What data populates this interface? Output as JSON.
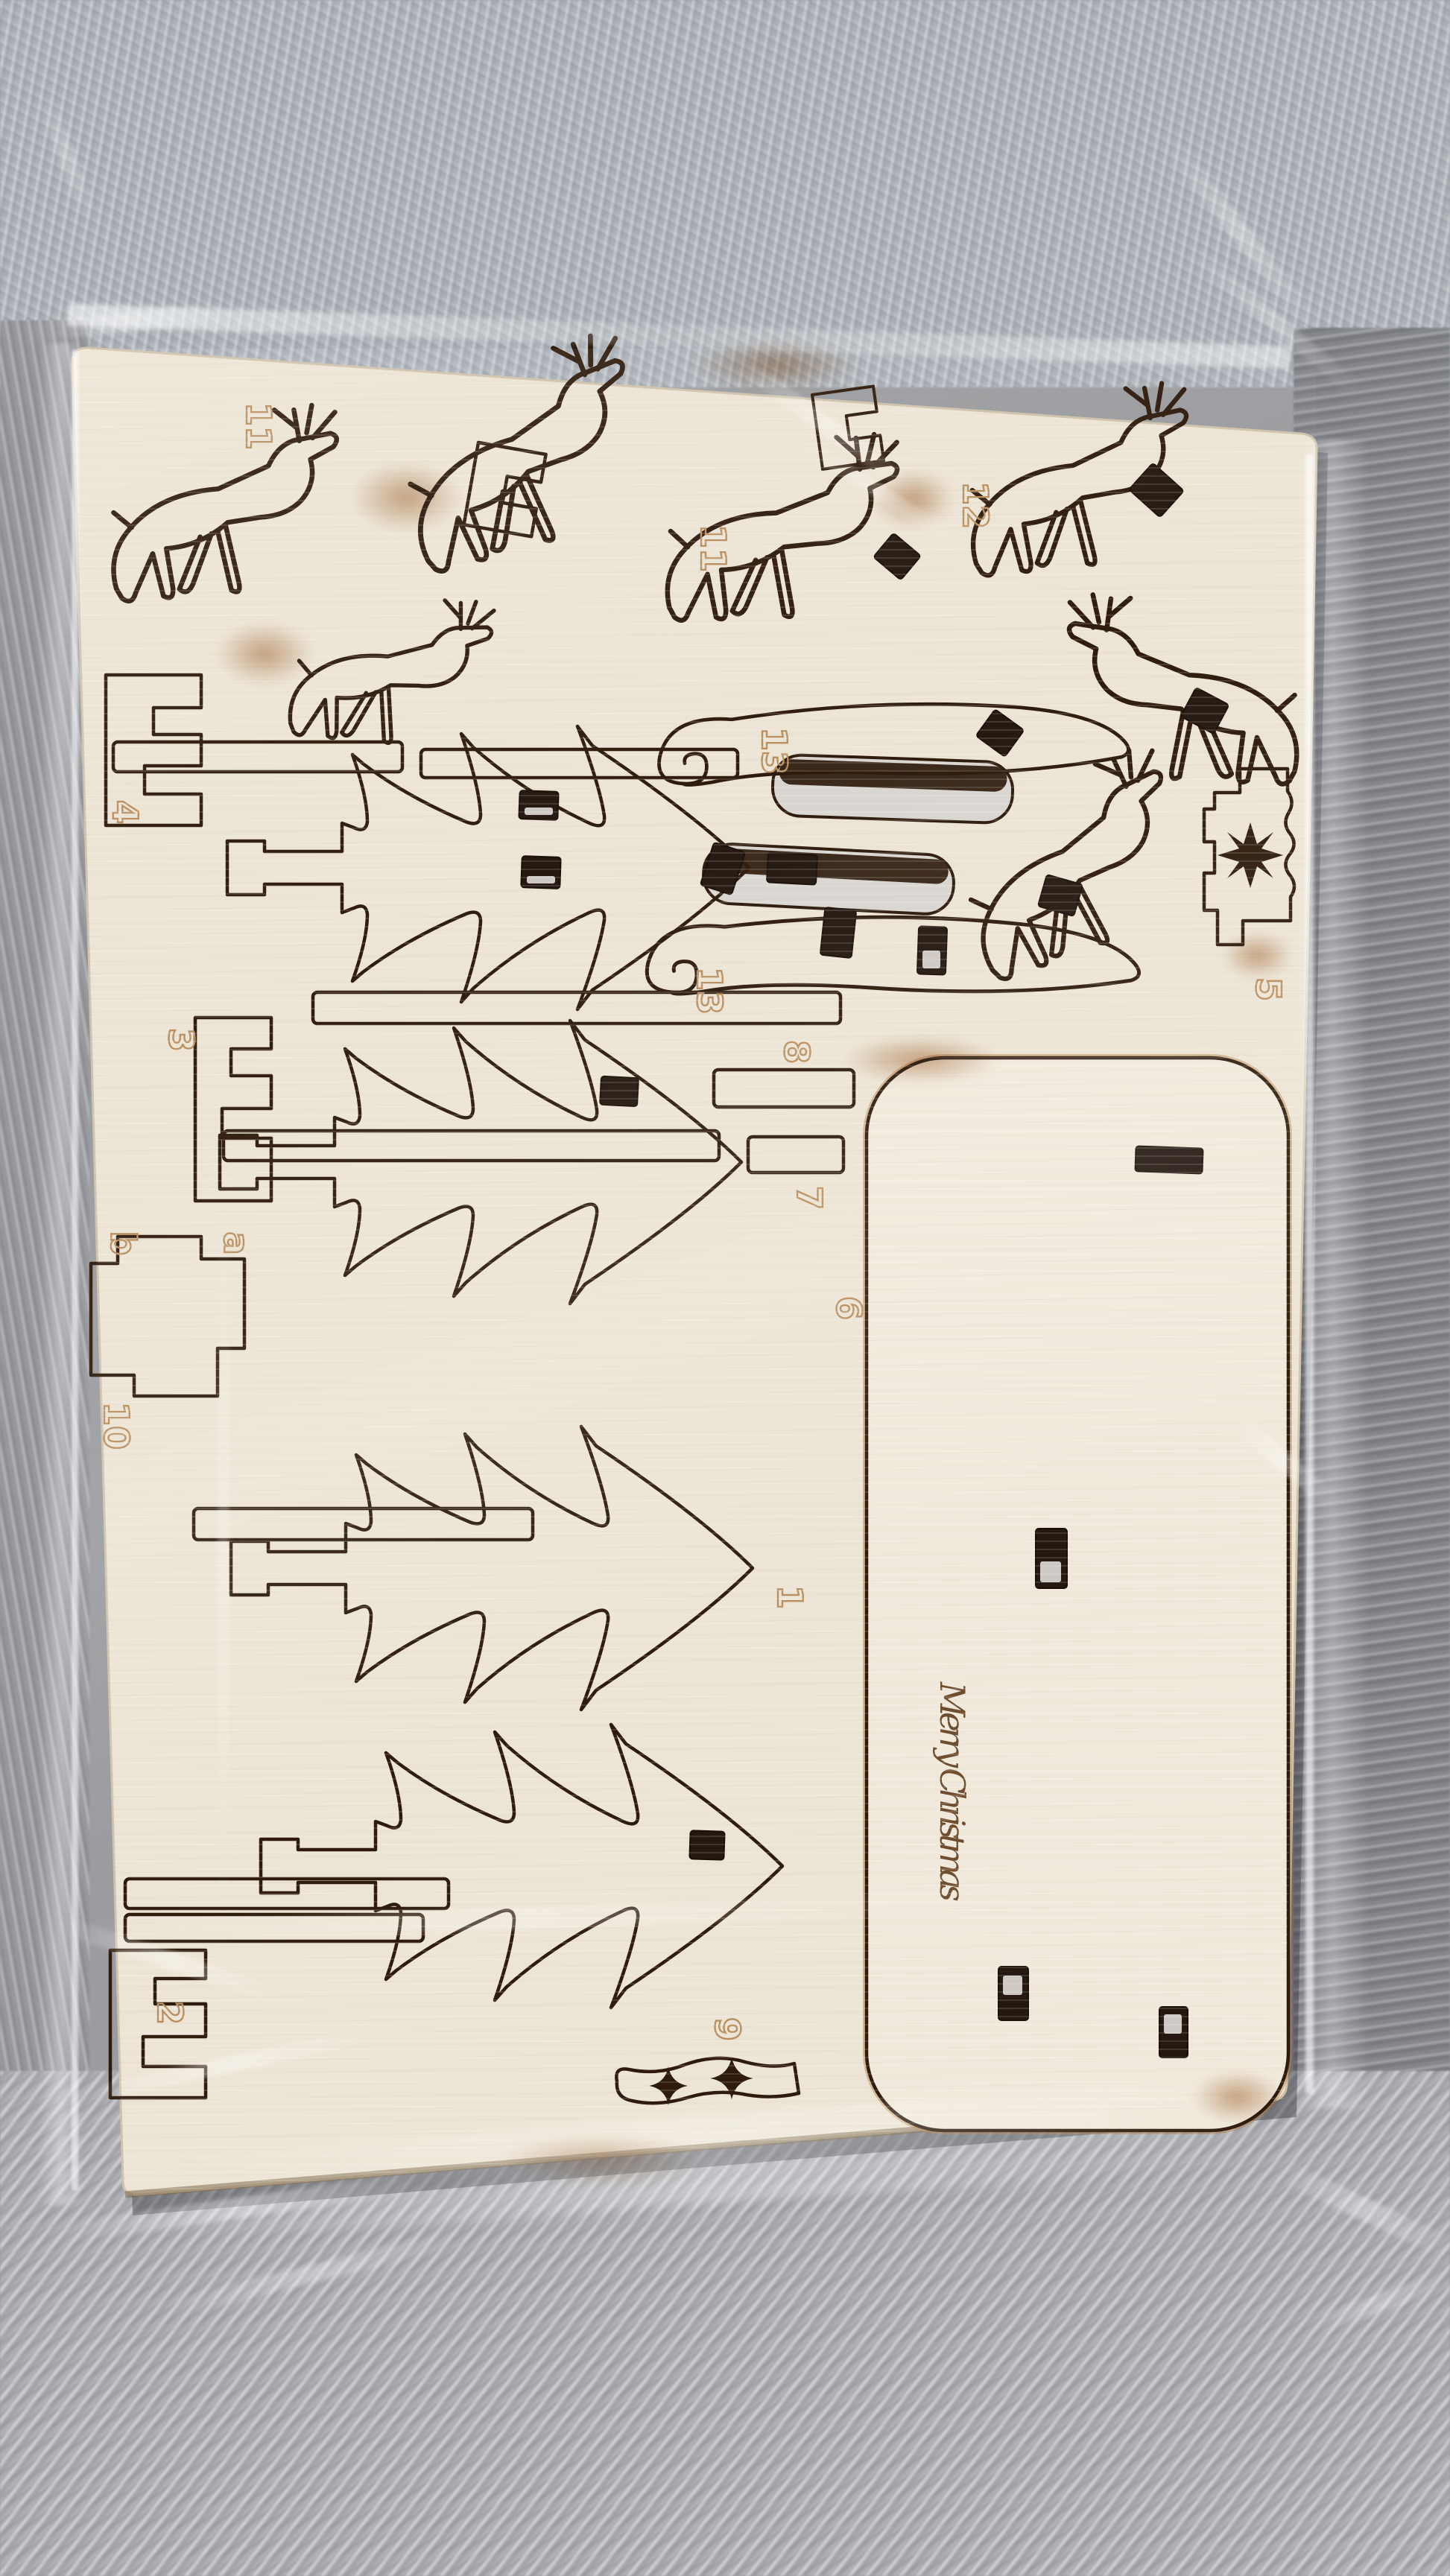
{
  "scene": {
    "description": "Laser-cut plywood Christmas craft kit sheet wrapped in clear plastic, lying on a grey fur blanket",
    "objects": [
      "fur-blanket",
      "plastic-wrap",
      "plywood-sheet"
    ]
  },
  "sheet": {
    "greeting": "Merry Christmas",
    "part_labels": [
      {
        "name": "part-11-top-left",
        "text": "11"
      },
      {
        "name": "part-11-top-right",
        "text": "11"
      },
      {
        "name": "part-12",
        "text": "12"
      },
      {
        "name": "part-13-upper-sleigh-runner",
        "text": "13"
      },
      {
        "name": "part-13-lower-sleigh-runner",
        "text": "13"
      },
      {
        "name": "part-4-stand",
        "text": "4"
      },
      {
        "name": "part-5-star-block",
        "text": "5"
      },
      {
        "name": "part-8-bar",
        "text": "8"
      },
      {
        "name": "part-7-bar",
        "text": "7"
      },
      {
        "name": "part-6-tree",
        "text": "6"
      },
      {
        "name": "part-3-stand",
        "text": "3"
      },
      {
        "name": "part-b-connector",
        "text": "b"
      },
      {
        "name": "part-a-connector",
        "text": "a"
      },
      {
        "name": "part-10-connector",
        "text": "10"
      },
      {
        "name": "part-1-tree",
        "text": "1"
      },
      {
        "name": "part-2-tree",
        "text": "2"
      },
      {
        "name": "part-9-snow-piece",
        "text": "9"
      }
    ],
    "decorations": {
      "part5_engraving": "eight-point-star",
      "part9_cutouts": [
        "four-point-sparkle",
        "four-point-sparkle"
      ]
    },
    "piece_kinds": [
      "reindeer-silhouette",
      "christmas-tree-silhouette",
      "sleigh-runner",
      "base-plate",
      "slot-cutout",
      "connector-block",
      "trunk-strip"
    ]
  },
  "colors": {
    "fur_base": "#9b9c9f",
    "fur_light": "#c8c9cd",
    "wood": "#ece4d4",
    "wood_plate": "#f0e9db",
    "wood_edge": "#cfc2ab",
    "cut_line": "#2e1b0c",
    "scorch": "#a86a34",
    "engraving_outline": "#b98f60",
    "greeting_text": "#6f4e2f",
    "slot_dark": "#241810",
    "slot_backing": "#d9d6d1",
    "wrap_highlight": "#ffffff"
  }
}
